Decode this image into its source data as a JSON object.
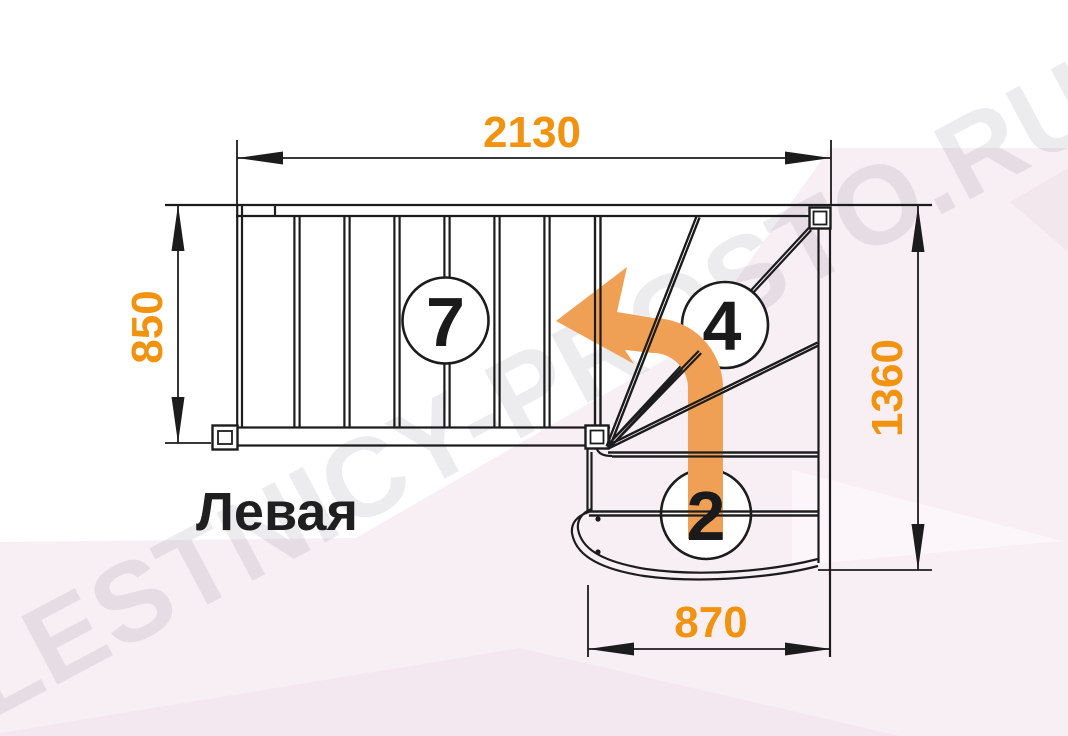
{
  "diagram": {
    "title": "Левая",
    "watermark": "LESTNICY-PROSTO.RU",
    "dimensions": {
      "top_width": "2130",
      "left_depth": "850",
      "right_height": "1360",
      "bottom_width": "870"
    },
    "step_counts": {
      "upper_flight": "7",
      "winder_flight": "4",
      "lower_flight": "2"
    },
    "colors": {
      "dimension_text": "#f1930e",
      "direction_arrow": "#f0a055",
      "drawing_lines": "#1c1c1c",
      "background_tint": "#f8eff4"
    }
  }
}
